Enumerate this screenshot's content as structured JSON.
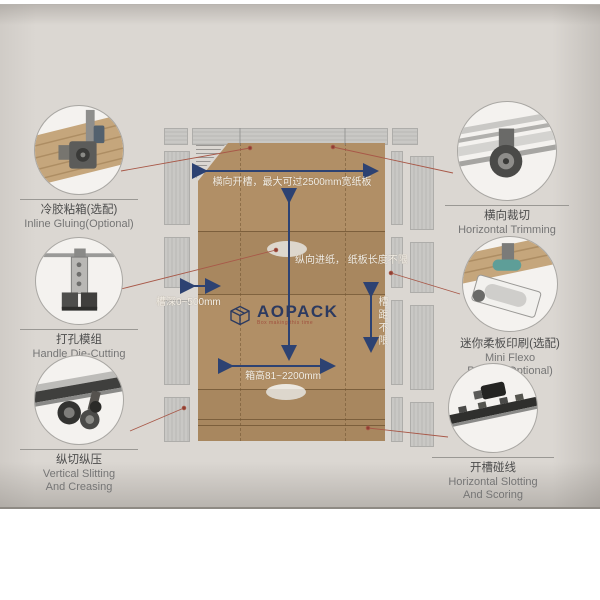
{
  "brand": {
    "name": "AOPACK",
    "tagline": "Box making this time"
  },
  "annotations": {
    "top_width": "横向开槽，最大可过2500mm宽纸板",
    "feed": "纵向进纸，\n纸板长度不限",
    "slot_depth": "槽深0~500mm",
    "box_height": "箱高81~2200mm",
    "slot_distance": "槽距不限"
  },
  "callouts": [
    {
      "zh": "冷胶粘箱(选配)",
      "en": "Inline Gluing(Optional)"
    },
    {
      "zh": "打孔模组",
      "en": "Handle Die-Cutting"
    },
    {
      "zh": "纵切纵压",
      "en": "Vertical Slitting\nAnd Creasing"
    },
    {
      "zh": "横向裁切",
      "en": "Horizontal Trimming"
    },
    {
      "zh": "迷你柔板印刷(选配)",
      "en": "Mini Flexo Printing(Optional)"
    },
    {
      "zh": "开槽碰线",
      "en": "Horizontal Slotting\nAnd Scoring"
    }
  ],
  "colors": {
    "cardboard": "#b18f66",
    "navy_accent": "#2d4272",
    "leader_red": "#a85848",
    "machine_gray": "#c6c5c2",
    "photo_background": "#dbd7d2"
  }
}
